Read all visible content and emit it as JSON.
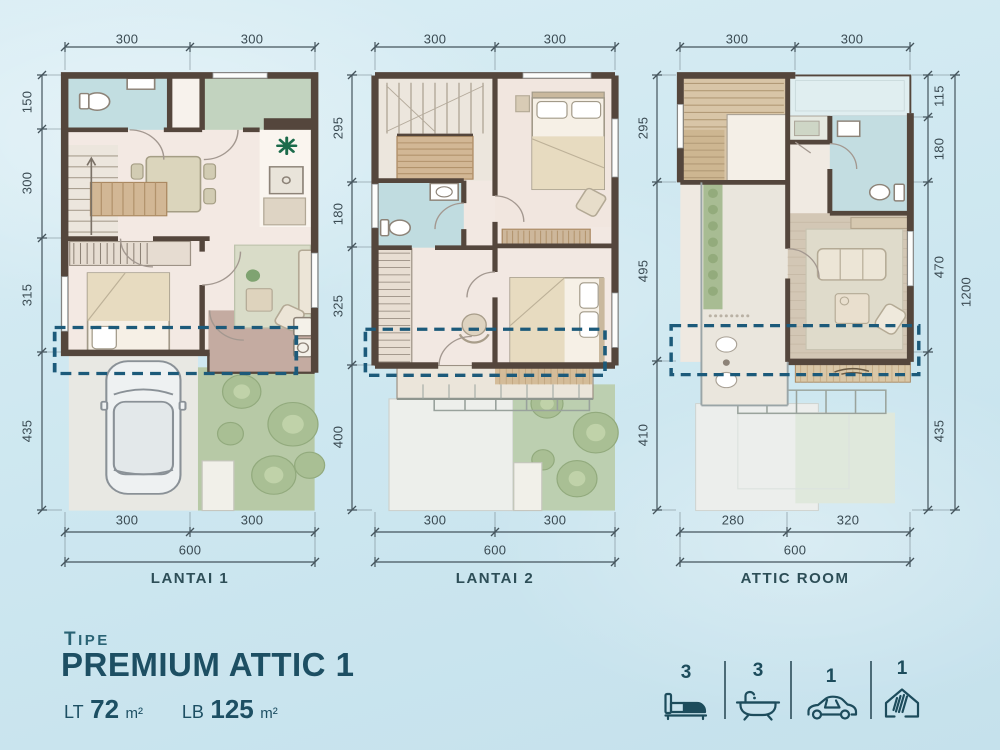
{
  "sheet": {
    "type_label": "TIPE",
    "type_name": "PREMIUM ATTIC 1"
  },
  "title": {
    "pretitle": "TIPE",
    "name": "PREMIUM ATTIC 1",
    "lt_label": "LT",
    "lt_value": "72",
    "lt_unit": "m²",
    "lb_label": "LB",
    "lb_value": "125",
    "lb_unit": "m²"
  },
  "plans": [
    {
      "label": "LANTAI 1",
      "dims_top": [
        "300",
        "300"
      ],
      "dims_left": [
        "150",
        "300",
        "315",
        "435"
      ],
      "dims_bottom": [
        "300",
        "300"
      ],
      "dims_bottom_total": "600"
    },
    {
      "label": "LANTAI 2",
      "dims_top": [
        "300",
        "300"
      ],
      "dims_left": [
        "295",
        "180",
        "325",
        "400"
      ],
      "dims_bottom": [
        "300",
        "300"
      ],
      "dims_bottom_total": "600"
    },
    {
      "label": "ATTIC ROOM",
      "dims_top": [
        "300",
        "300"
      ],
      "dims_left": [
        "295",
        "495",
        "410"
      ],
      "dims_right": [
        "115",
        "180",
        "470",
        "435"
      ],
      "dims_right_total": "1200",
      "dims_bottom": [
        "280",
        "320"
      ],
      "dims_bottom_total": "600"
    }
  ],
  "features": [
    {
      "name": "bedrooms",
      "icon": "bed-icon",
      "count": "3"
    },
    {
      "name": "bathrooms",
      "icon": "bath-icon",
      "count": "3"
    },
    {
      "name": "carport",
      "icon": "car-icon",
      "count": "1"
    },
    {
      "name": "attic",
      "icon": "attic-house-icon",
      "count": "1"
    }
  ],
  "colors": {
    "background": "#cfe7f0",
    "wall": "#54463c",
    "dashed_outline": "#1c5a7a",
    "accent_text": "#1d4f63",
    "dim_text": "#3a4a52",
    "floor_cream": "#f3e9e3",
    "bathroom_blue": "#c2dee1",
    "garden_green": "#b7c9a6",
    "carport_grey": "#e8e8e3",
    "terrace_mauve": "#c4aba1",
    "wood": "#d2b795",
    "icon_teal": "#1d4c5c"
  }
}
